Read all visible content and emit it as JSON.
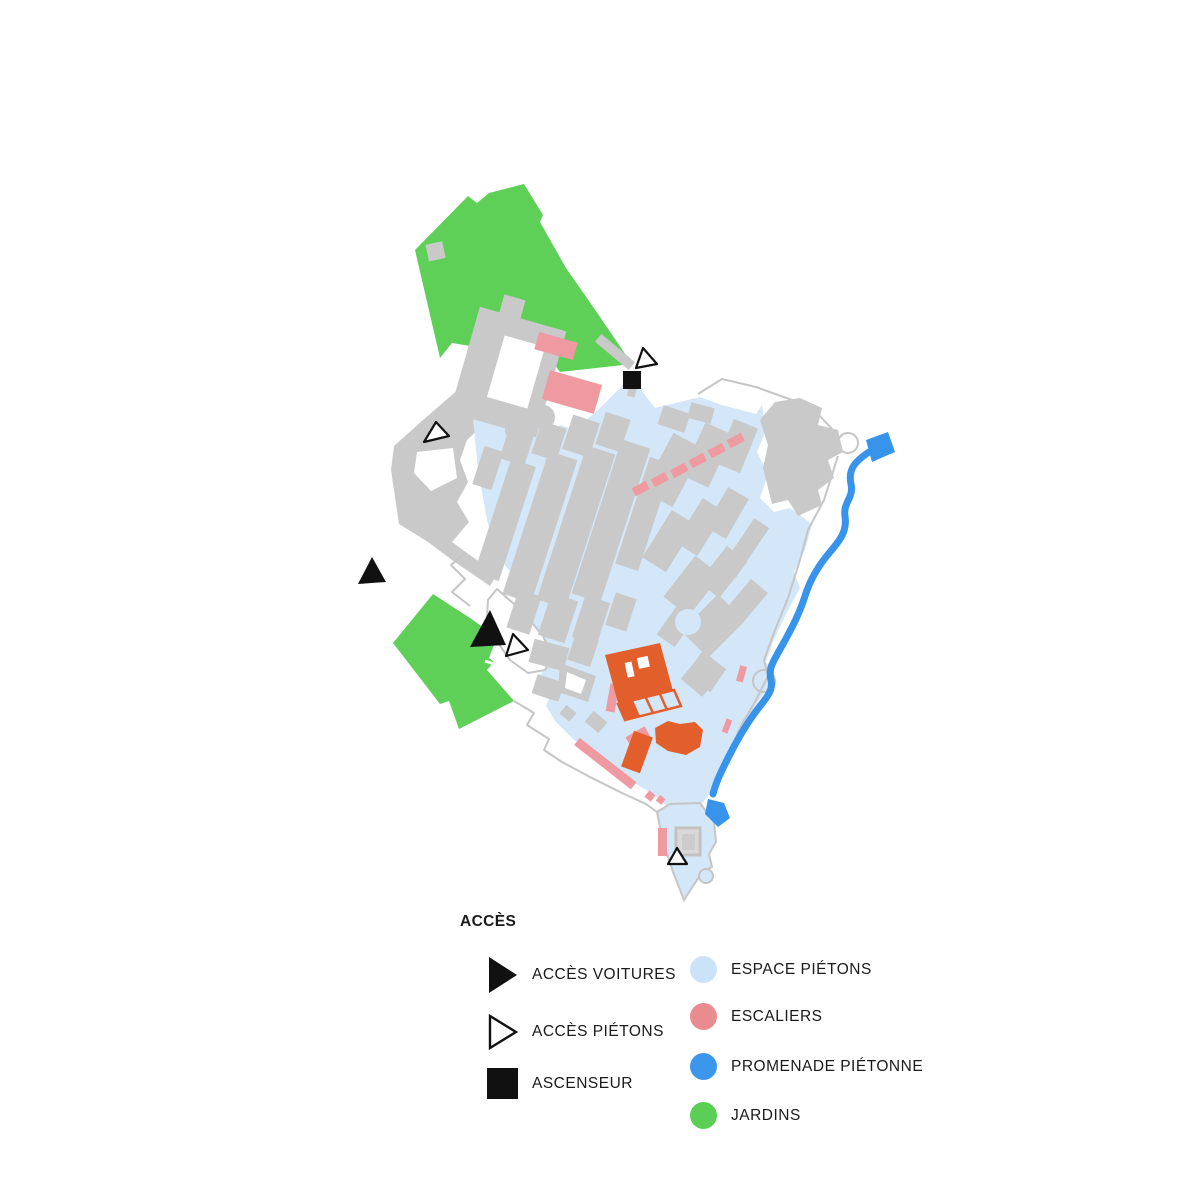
{
  "page": {
    "type": "site-plan-map",
    "background": "#ffffff"
  },
  "legend": {
    "title": "ACCÈS",
    "access_items": [
      {
        "label": "ACCÈS VOITURES",
        "icon": "filled-triangle-right-icon"
      },
      {
        "label": "ACCÈS PIÉTONS",
        "icon": "outline-triangle-right-icon"
      },
      {
        "label": "ASCENSEUR",
        "icon": "filled-square-icon"
      }
    ],
    "area_items": [
      {
        "label": "ESPACE PIÉTONS",
        "color": "#cbe3f8"
      },
      {
        "label": "ESCALIERS",
        "color": "#e98c90"
      },
      {
        "label": "PROMENADE PIÉTONNE",
        "color": "#3b96ec"
      },
      {
        "label": "JARDINS",
        "color": "#5bcf55"
      }
    ]
  },
  "colors": {
    "espace_pietons": "#d3e7f8",
    "escaliers": "#ef9aa0",
    "promenade_pietonne": "#3794ea",
    "jardins": "#5ed058",
    "batiments": "#c9c9c9",
    "remparts": "#c5c5c5",
    "batiment_orange": "#e25f2b",
    "marqueur": "#111111",
    "texte": "#1a1a1a"
  },
  "map": {
    "markers": {
      "acces_voitures": [
        {
          "x": 371,
          "y": 572
        },
        {
          "x": 488,
          "y": 628
        }
      ],
      "acces_pietons": [
        {
          "x": 644,
          "y": 357
        },
        {
          "x": 435,
          "y": 432
        },
        {
          "x": 514,
          "y": 646
        },
        {
          "x": 677,
          "y": 857
        }
      ],
      "ascenseur": [
        {
          "x": 632,
          "y": 380
        }
      ]
    }
  }
}
